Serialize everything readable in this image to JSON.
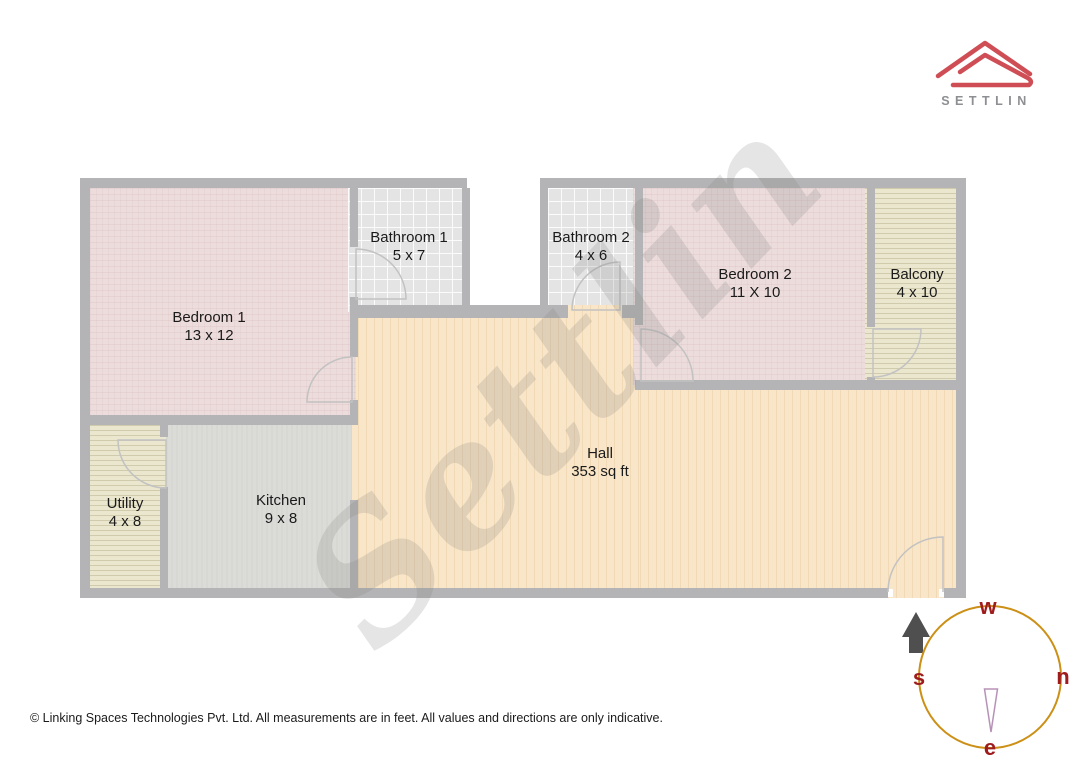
{
  "brand": {
    "logo_text": "SETTLIN"
  },
  "watermark_text": "Settlin",
  "rooms": [
    {
      "name": "Bedroom 1",
      "dims": "13 x 12"
    },
    {
      "name": "Bathroom 1",
      "dims": "5 x 7"
    },
    {
      "name": "Bathroom 2",
      "dims": "4 x 6"
    },
    {
      "name": "Bedroom 2",
      "dims": "11 X 10"
    },
    {
      "name": "Balcony",
      "dims": "4 x 10"
    },
    {
      "name": "Utility",
      "dims": "4 x 8"
    },
    {
      "name": "Kitchen",
      "dims": "9 x 8"
    },
    {
      "name": "Hall",
      "dims": "353 sq ft"
    }
  ],
  "compass": {
    "top": "w",
    "left": "s",
    "right": "n",
    "bottom": "e"
  },
  "footer_note": "© Linking Spaces Technologies Pvt. Ltd. All measurements are in feet. All values and directions are only indicative.",
  "colors": {
    "wall": "#b4b4b6",
    "bedroom-fill": "#eddcdc",
    "tile-fill": "#e4e4e4",
    "stripe-fill": "#ebe6ce",
    "kitchen-fill": "#dbdbd8",
    "hall-fill": "#f9e5c7",
    "logo-red": "#cf4e56",
    "logo-gray": "#8d8f93",
    "compass-ring": "#cc9016",
    "compass-letter": "#9e1b1e",
    "needle": "#b792b7",
    "arrow": "#4f4f4f",
    "door-arc": "#c2c2c2",
    "text": "#1a1a1a"
  }
}
